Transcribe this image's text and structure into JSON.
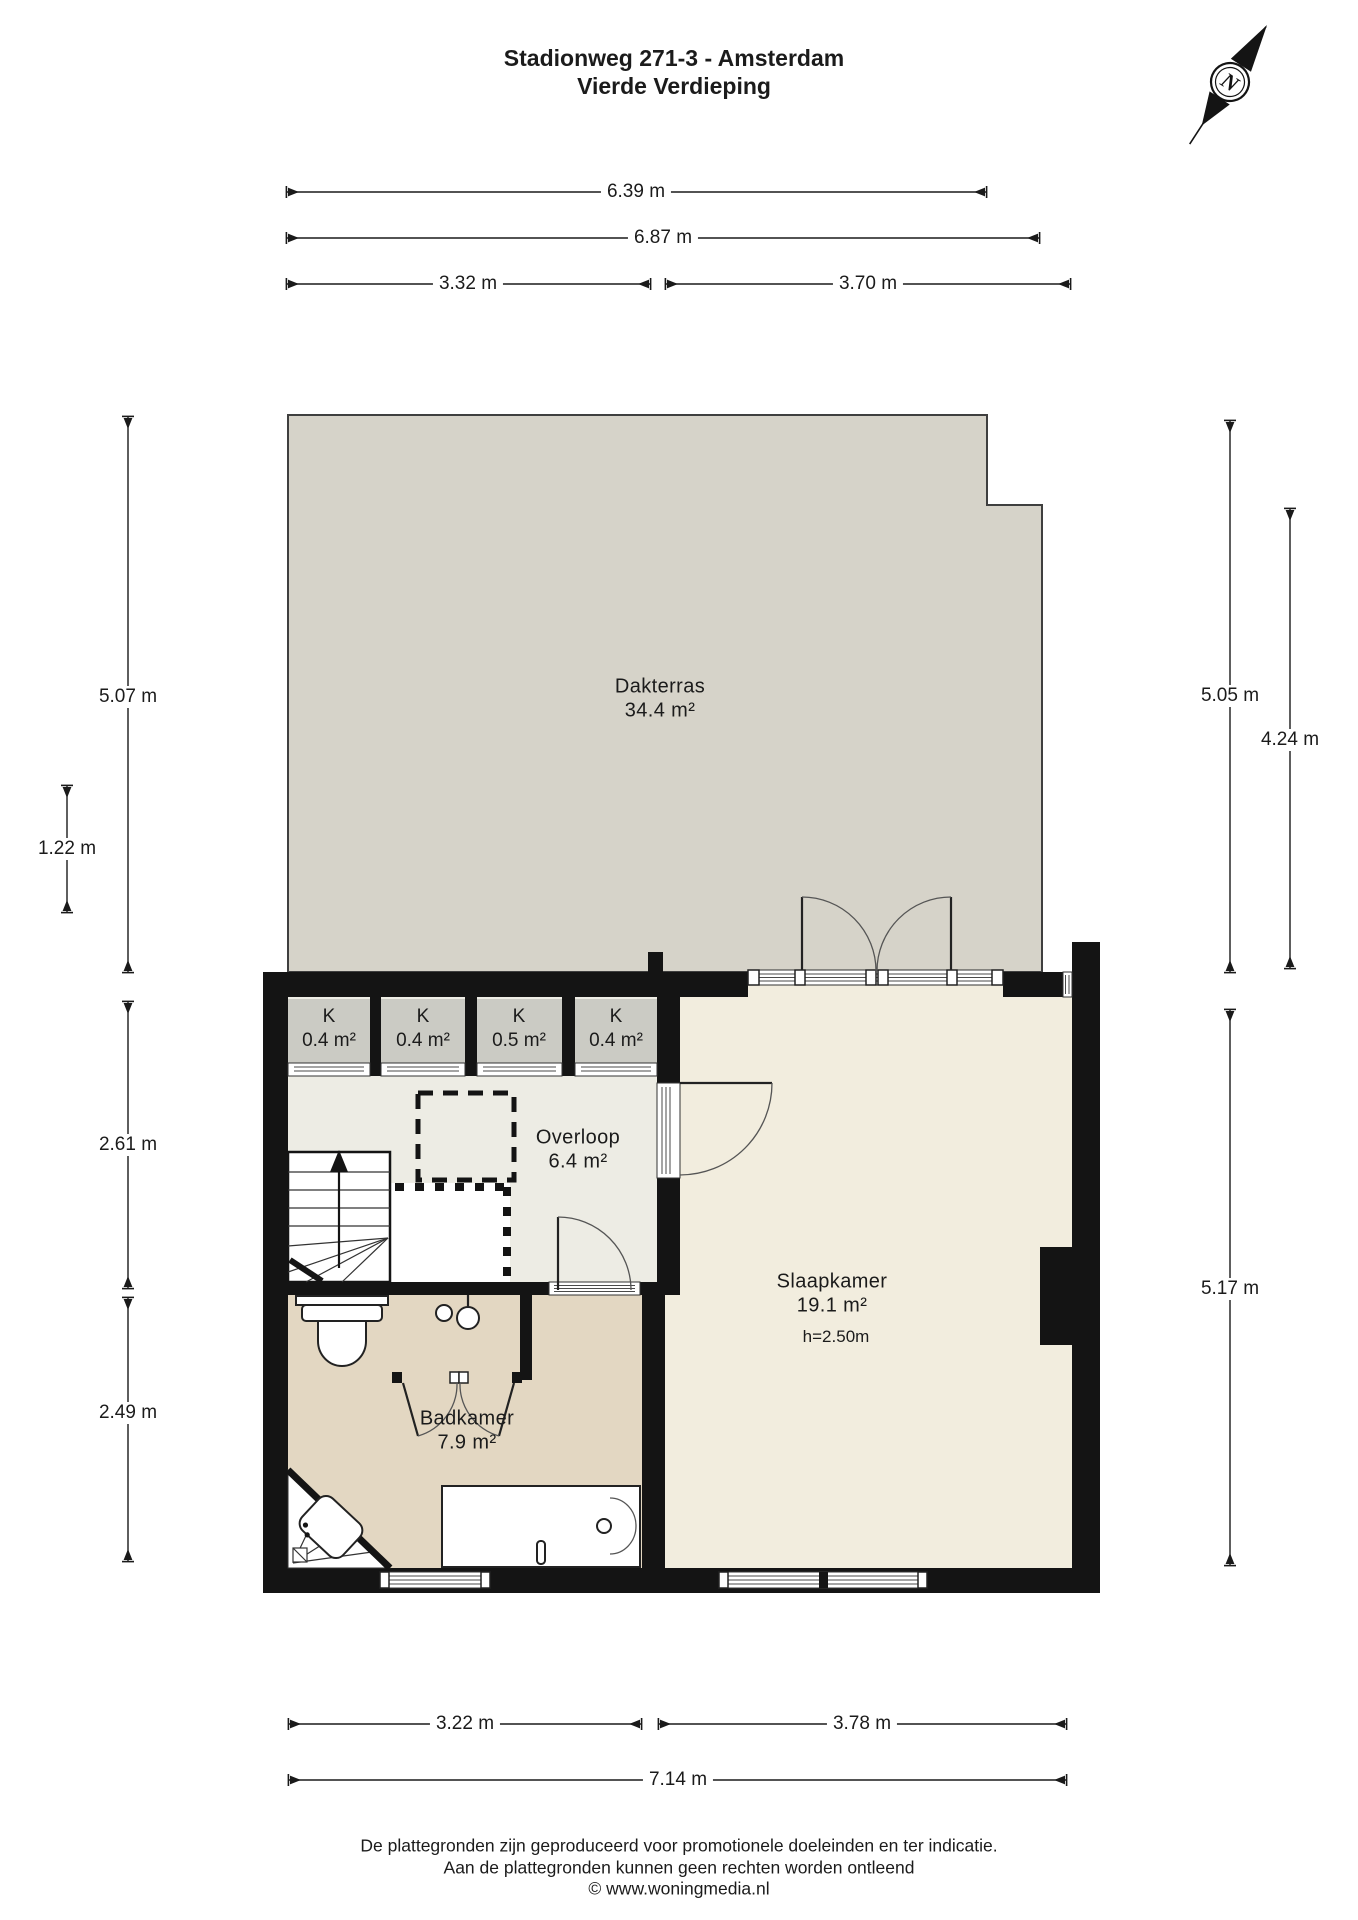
{
  "title": {
    "line1": "Stadionweg 271-3 - Amsterdam",
    "line2": "Vierde Verdieping"
  },
  "compass": {
    "label": "N"
  },
  "rooms": {
    "dakterras": {
      "name": "Dakterras",
      "area": "34.4 m²"
    },
    "closets": [
      {
        "name": "K",
        "area": "0.4 m²"
      },
      {
        "name": "K",
        "area": "0.4 m²"
      },
      {
        "name": "K",
        "area": "0.5 m²"
      },
      {
        "name": "K",
        "area": "0.4 m²"
      }
    ],
    "overloop": {
      "name": "Overloop",
      "area": "6.4 m²"
    },
    "slaapkamer": {
      "name": "Slaapkamer",
      "area": "19.1 m²",
      "ceiling_height": "h=2.50m"
    },
    "badkamer": {
      "name": "Badkamer",
      "area": "7.9 m²"
    }
  },
  "dimensions": {
    "top_inner_width": "6.39 m",
    "top_outer_width": "6.87 m",
    "top_left_section": "3.32 m",
    "top_right_section": "3.70 m",
    "left_terrace": "5.07 m",
    "left_small": "1.22 m",
    "left_overloop": "2.61 m",
    "left_badkamer": "2.49 m",
    "right_terrace": "5.05 m",
    "right_terrace_section": "4.24 m",
    "right_rooms": "5.17 m",
    "bottom_left_section": "3.22 m",
    "bottom_right_section": "3.78 m",
    "bottom_total": "7.14 m"
  },
  "footer": {
    "line1": "De plattegronden zijn geproduceerd voor promotionele doeleinden en ter indicatie.",
    "line2": "Aan de plattegronden kunnen geen rechten worden ontleend",
    "line3": "© www.woningmedia.nl"
  },
  "colors": {
    "wall": "#141414",
    "dakterras_floor": "#d6d3c9",
    "closet_floor": "#cbcbc4",
    "overloop_floor": "#edece4",
    "slaapkamer_floor": "#f2edde",
    "badkamer_floor": "#e3d7c2",
    "outline": "#3f3f3f"
  }
}
